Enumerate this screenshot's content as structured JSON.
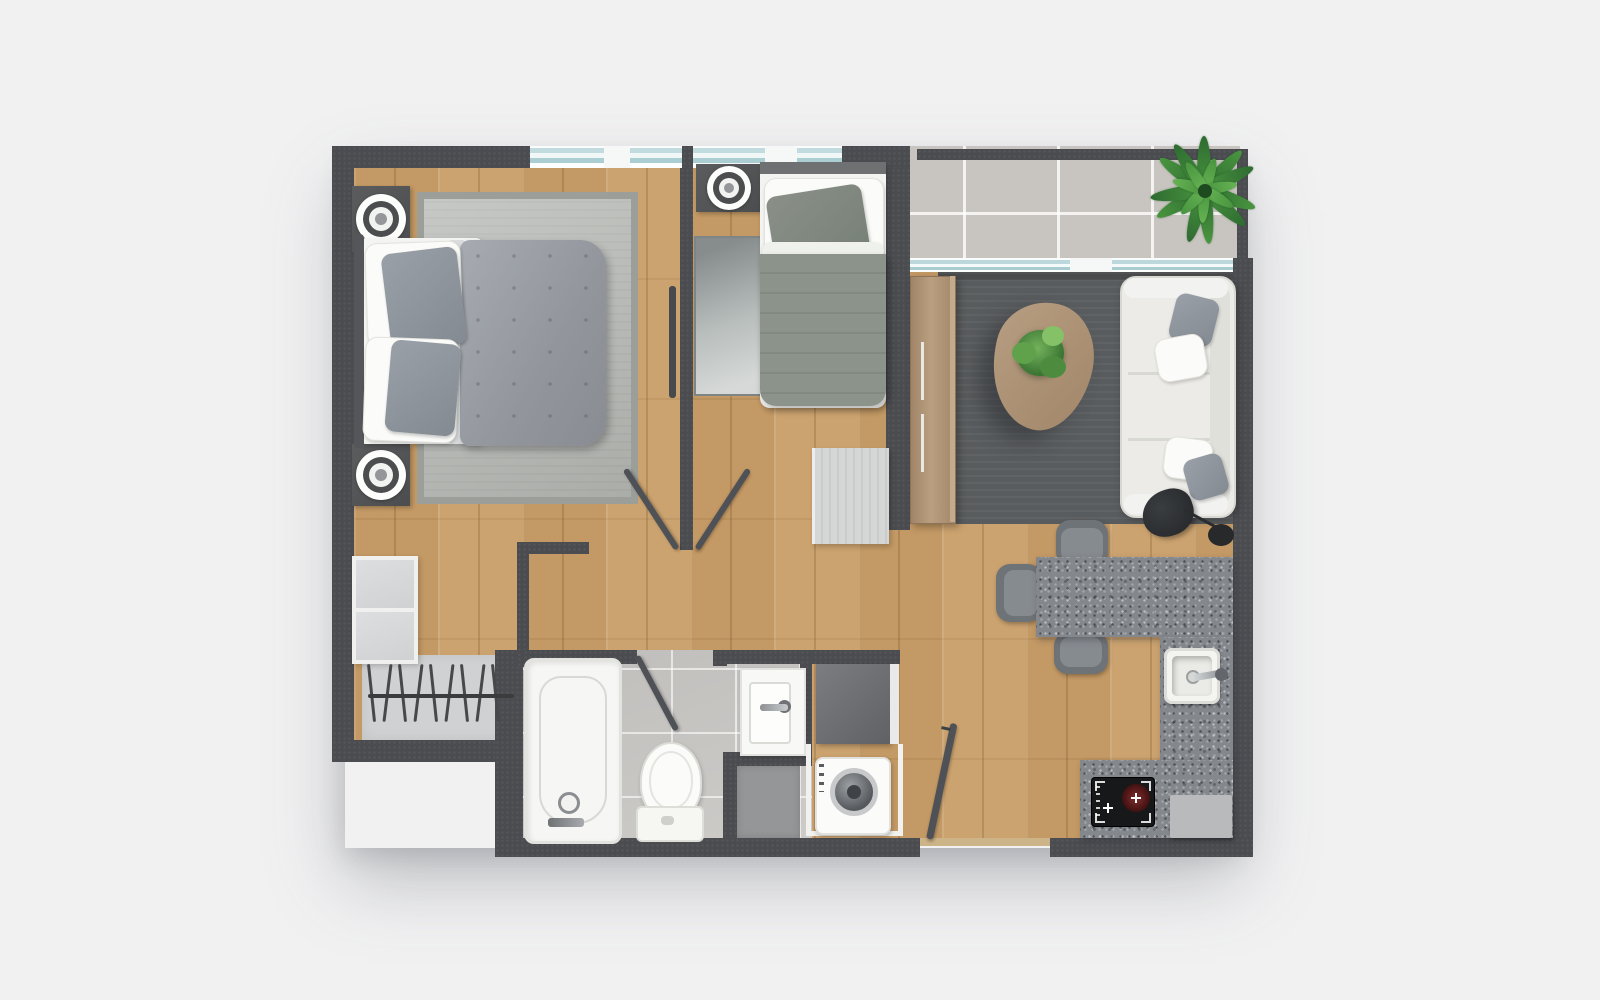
{
  "meta": {
    "type": "floor-plan",
    "view": "top-down-3d-render",
    "text_visible": false
  },
  "palette": {
    "bg": "#f1f1f2",
    "wall": "#4a4c50",
    "wood": "#c79e6b",
    "tile-balcony": "#c8c5c0",
    "tile-bath": "#cac8c5",
    "granite": "#84888d",
    "rug-master": "#b4b6b2",
    "rug-master-border": "#9c9e9a",
    "rug-living": "#595c5e",
    "duvet-master": "#9ba0a6",
    "duvet-single": "#8c938b",
    "sofa": "#ecebe7",
    "wood-furniture": "#ae9276",
    "door": "#4e5156",
    "shelf": "#d6d8da",
    "closet-base": "#d0d1d3",
    "appliance-dark": "#6e7073",
    "shaft": "#949698",
    "stove": "#17181a",
    "burner": "#5c1f1f",
    "plant-dark": "#2e6b31",
    "plant-mid": "#49953f",
    "plant-light": "#66b253",
    "window-glass": "#b9d6da",
    "fixture-white": "#f6f6f4"
  },
  "rooms": [
    {
      "name": "master-bedroom"
    },
    {
      "name": "bedroom-2"
    },
    {
      "name": "hallway"
    },
    {
      "name": "bathroom"
    },
    {
      "name": "laundry-niche"
    },
    {
      "name": "living-room"
    },
    {
      "name": "kitchen-dining"
    },
    {
      "name": "balcony"
    }
  ],
  "inventory": {
    "double-bed": 1,
    "single-bed": 1,
    "nightstand-lamps": 3,
    "rugs": 3,
    "wardrobe-shelves": 1,
    "clothes-rail": 1,
    "sofa": 1,
    "coffee-table": 1,
    "tv-console": 1,
    "floor-lamp": 1,
    "bar-stools": 3,
    "kitchen-sink": 1,
    "cooktop": 1,
    "bathtub": 1,
    "toilet": 1,
    "bathroom-sink": 1,
    "washing-machine": 1,
    "laundry-cabinet": 1,
    "plants": 2,
    "door-leaves": 4,
    "windows": 3
  },
  "decor": {
    "closet_hangers": 9,
    "balcony_plant_leaves_outer": 11,
    "balcony_plant_leaves_inner": 7,
    "table_plant_leaves": 8
  }
}
